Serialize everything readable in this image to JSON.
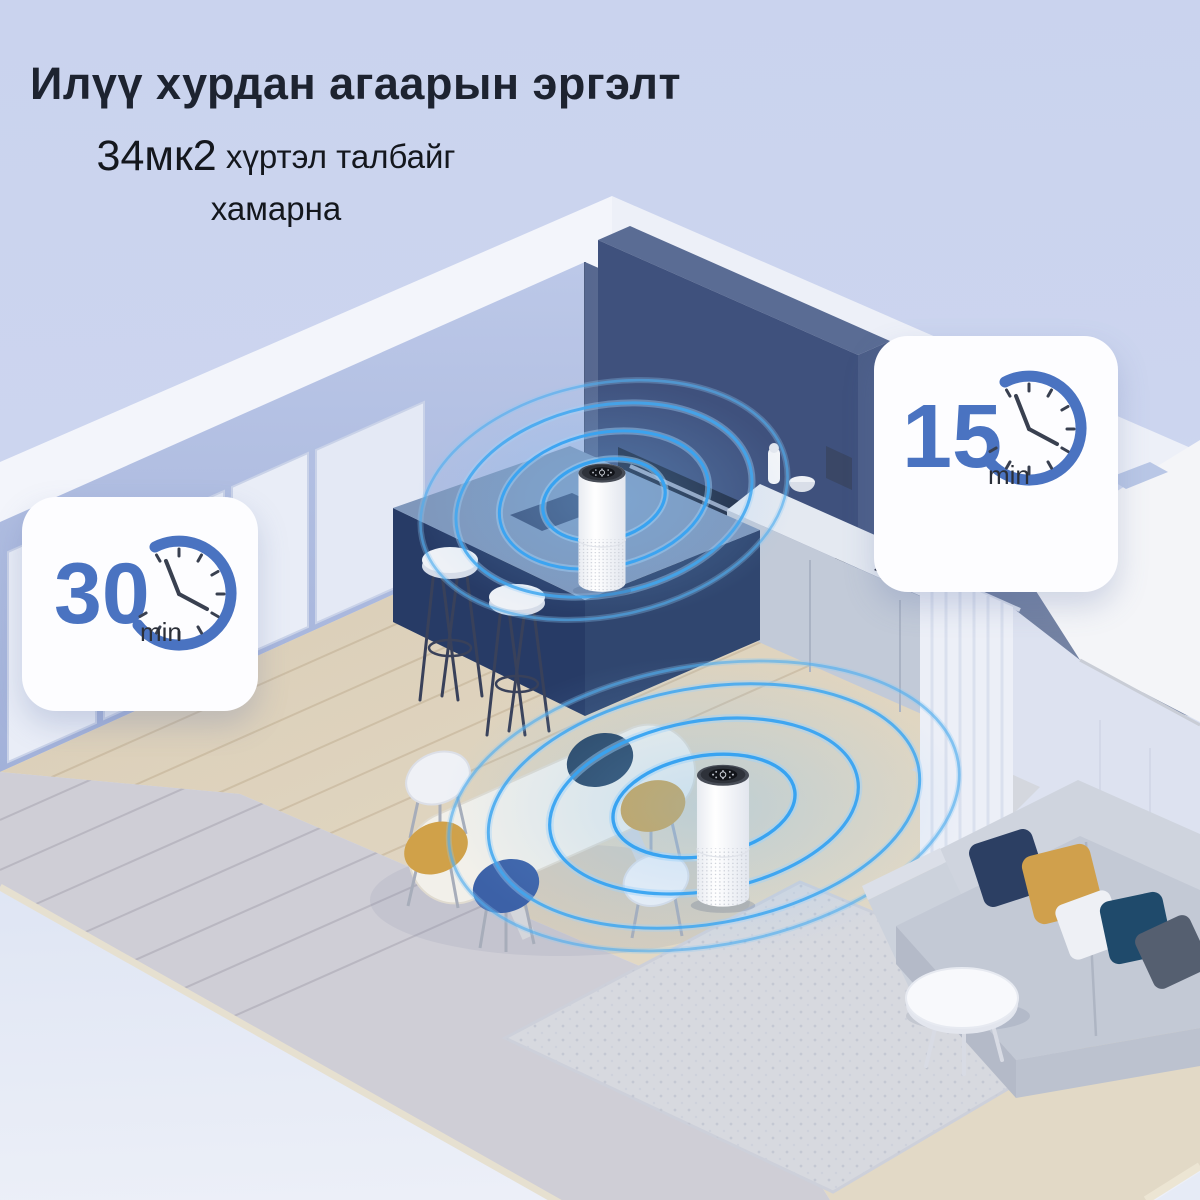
{
  "header": {
    "title": "Илүү хурдан агаарын эргэлт",
    "subtitle": {
      "highlight": "34мк2",
      "rest": " хүртэл талбайг",
      "line2": "хамарна"
    }
  },
  "badges": {
    "left": {
      "name": "timer-30min",
      "value": "30",
      "unit": "min",
      "icon": "clock-icon"
    },
    "right": {
      "name": "timer-15min",
      "value": "15",
      "unit": "min",
      "icon": "clock-icon"
    }
  },
  "colors": {
    "background_top": "#ccd5ef",
    "background_bottom": "#edf0f8",
    "title_text": "#1d2330",
    "subtitle_text": "#14171d",
    "badge_background": "#fdfdff",
    "badge_accent_blue": "#4a73c1",
    "badge_unit_text": "#2b2f38",
    "ripple_blue": "#38a3f1",
    "wall_left_blue": "#b3c0e2",
    "wall_kitchen_slate": "#62739a",
    "island_navy": "#273b66",
    "wood_floor": "#dccfb9",
    "gray_floor": "#cfced6",
    "rug_gray": "#d7d9df",
    "sofa_gray": "#c5cbd6",
    "pillow_navy": "#2c3f63",
    "pillow_mustard": "#d0a04c",
    "pillow_teal": "#1f4a6b"
  },
  "scene": {
    "description": "Isometric cutaway of an open-plan kitchen and living room; two air purifiers emit blue coverage ripples",
    "objects": [
      "ceiling",
      "left-wall",
      "sliding-doors",
      "kitchen-back-wall",
      "range-hood",
      "built-in-oven",
      "kitchen-counter",
      "cooktop",
      "kitchen-island",
      "island-sink",
      "bar-stools",
      "air-purifier-kitchen",
      "air-purifier-living",
      "coverage-ripples",
      "dining-table",
      "dining-chairs",
      "sofa",
      "throw-pillows",
      "coffee-table",
      "rug",
      "curtain",
      "wood-floor",
      "gray-floor"
    ]
  }
}
